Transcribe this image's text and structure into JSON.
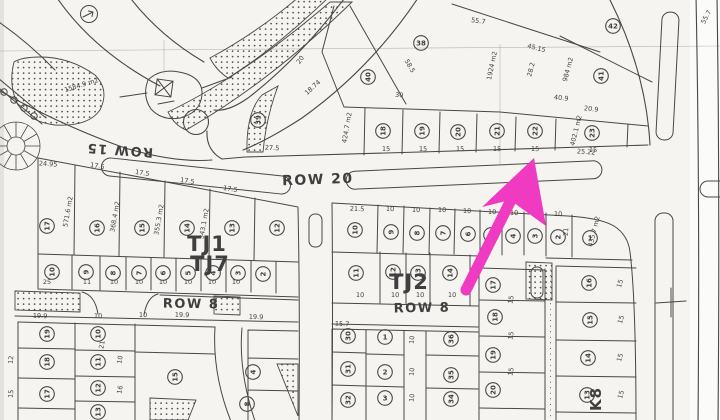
{
  "map": {
    "type": "cadastral-plat-map",
    "road_labels": [
      {
        "t": "ROW 15",
        "x": 120,
        "y": 146,
        "rot": 184,
        "size": 13
      },
      {
        "t": "ROW 20",
        "x": 318,
        "y": 184,
        "rot": -2,
        "size": 14
      },
      {
        "t": "ROW 8",
        "x": 191,
        "y": 308,
        "rot": 1,
        "size": 13
      },
      {
        "t": "ROW 8",
        "x": 422,
        "y": 312,
        "rot": -1,
        "size": 13
      }
    ],
    "block_labels": [
      {
        "t": "TJ1",
        "x": 207,
        "y": 251,
        "rot": 0,
        "size": 21
      },
      {
        "t": "TJ7",
        "x": 210,
        "y": 271,
        "rot": 0,
        "size": 21
      },
      {
        "t": "TJ2",
        "x": 409,
        "y": 289,
        "rot": 0,
        "size": 21
      },
      {
        "t": "K8",
        "x": 601,
        "y": 399,
        "rot": -90,
        "size": 15
      }
    ],
    "area_labels": [
      {
        "t": "1584.9 m2",
        "x": 82,
        "y": 87,
        "rot": -17
      },
      {
        "t": "1924 m2",
        "x": 494,
        "y": 66,
        "rot": -78
      },
      {
        "t": "984 m2",
        "x": 570,
        "y": 70,
        "rot": -75
      },
      {
        "t": "424.7 m2",
        "x": 349,
        "y": 128,
        "rot": -80
      },
      {
        "t": "402.1 m2",
        "x": 578,
        "y": 131,
        "rot": -76
      },
      {
        "t": "435.7 m2",
        "x": 596,
        "y": 232,
        "rot": -76
      },
      {
        "t": "571.6 m2",
        "x": 70,
        "y": 212,
        "rot": -80
      },
      {
        "t": "368.4 m2",
        "x": 117,
        "y": 217,
        "rot": -80
      },
      {
        "t": "355.3 m2",
        "x": 161,
        "y": 220,
        "rot": -80
      },
      {
        "t": "343.1 m2",
        "x": 206,
        "y": 224,
        "rot": -80
      }
    ],
    "dim_labels": [
      {
        "t": "55.7",
        "x": 478,
        "y": 23,
        "rot": 8
      },
      {
        "t": "58.5",
        "x": 408,
        "y": 67,
        "rot": 60
      },
      {
        "t": "30",
        "x": 399,
        "y": 97,
        "rot": 5
      },
      {
        "t": "20",
        "x": 302,
        "y": 61,
        "rot": -55
      },
      {
        "t": "18.74",
        "x": 314,
        "y": 89,
        "rot": -42
      },
      {
        "t": "28.2",
        "x": 533,
        "y": 70,
        "rot": -75
      },
      {
        "t": "45.15",
        "x": 536,
        "y": 50,
        "rot": 14
      },
      {
        "t": "27.5",
        "x": 272,
        "y": 150,
        "rot": 3
      },
      {
        "t": "40.9",
        "x": 561,
        "y": 100,
        "rot": 6
      },
      {
        "t": "20.9",
        "x": 591,
        "y": 111,
        "rot": 6
      },
      {
        "t": "25.22",
        "x": 586,
        "y": 154,
        "rot": 4
      },
      {
        "t": "55.7",
        "x": 708,
        "y": 18,
        "rot": -62
      },
      {
        "t": "15",
        "x": 386,
        "y": 151,
        "rot": 2
      },
      {
        "t": "15",
        "x": 423,
        "y": 151,
        "rot": 2
      },
      {
        "t": "15",
        "x": 460,
        "y": 151,
        "rot": 2
      },
      {
        "t": "15",
        "x": 497,
        "y": 151,
        "rot": 2
      },
      {
        "t": "15",
        "x": 535,
        "y": 151,
        "rot": 2
      },
      {
        "t": "15",
        "x": 593,
        "y": 152,
        "rot": 2
      },
      {
        "t": "24.95",
        "x": 48,
        "y": 166,
        "rot": 4
      },
      {
        "t": "17.5",
        "x": 97,
        "y": 168,
        "rot": 9
      },
      {
        "t": "17.5",
        "x": 142,
        "y": 175,
        "rot": 9
      },
      {
        "t": "17.5",
        "x": 187,
        "y": 183,
        "rot": 9
      },
      {
        "t": "17.5",
        "x": 230,
        "y": 191,
        "rot": 9
      },
      {
        "t": "25",
        "x": 47,
        "y": 284,
        "rot": 0
      },
      {
        "t": "11",
        "x": 87,
        "y": 284,
        "rot": 0
      },
      {
        "t": "10",
        "x": 114,
        "y": 284,
        "rot": 0
      },
      {
        "t": "10",
        "x": 139,
        "y": 284,
        "rot": 0
      },
      {
        "t": "10",
        "x": 163,
        "y": 284,
        "rot": 0
      },
      {
        "t": "10",
        "x": 188,
        "y": 284,
        "rot": 0
      },
      {
        "t": "10",
        "x": 212,
        "y": 284,
        "rot": 0
      },
      {
        "t": "10",
        "x": 236,
        "y": 284,
        "rot": 0
      },
      {
        "t": "21.5",
        "x": 357,
        "y": 211,
        "rot": 2
      },
      {
        "t": "10",
        "x": 390,
        "y": 211,
        "rot": 2
      },
      {
        "t": "10",
        "x": 416,
        "y": 212,
        "rot": 2
      },
      {
        "t": "10",
        "x": 442,
        "y": 212,
        "rot": 2
      },
      {
        "t": "10",
        "x": 467,
        "y": 213,
        "rot": 2
      },
      {
        "t": "10",
        "x": 492,
        "y": 214,
        "rot": 2
      },
      {
        "t": "10",
        "x": 514,
        "y": 215,
        "rot": 2
      },
      {
        "t": "10",
        "x": 536,
        "y": 216,
        "rot": 2
      },
      {
        "t": "10",
        "x": 558,
        "y": 216,
        "rot": 2
      },
      {
        "t": "21",
        "x": 568,
        "y": 232,
        "rot": -85
      },
      {
        "t": "10",
        "x": 360,
        "y": 297,
        "rot": 2
      },
      {
        "t": "10",
        "x": 395,
        "y": 297,
        "rot": 2
      },
      {
        "t": "10",
        "x": 420,
        "y": 297,
        "rot": 2
      },
      {
        "t": "10",
        "x": 452,
        "y": 297,
        "rot": 2
      },
      {
        "t": "19.9",
        "x": 40,
        "y": 318,
        "rot": 2
      },
      {
        "t": "10",
        "x": 98,
        "y": 318,
        "rot": 2
      },
      {
        "t": "10",
        "x": 143,
        "y": 317,
        "rot": 2
      },
      {
        "t": "19.9",
        "x": 182,
        "y": 317,
        "rot": 2
      },
      {
        "t": "19.9",
        "x": 256,
        "y": 319,
        "rot": 2
      },
      {
        "t": "12",
        "x": 13,
        "y": 360,
        "rot": -85
      },
      {
        "t": "15",
        "x": 13,
        "y": 394,
        "rot": -85
      },
      {
        "t": "21",
        "x": 104,
        "y": 345,
        "rot": -80
      },
      {
        "t": "10",
        "x": 122,
        "y": 360,
        "rot": -80
      },
      {
        "t": "16",
        "x": 122,
        "y": 390,
        "rot": -80
      },
      {
        "t": "15.7",
        "x": 342,
        "y": 326,
        "rot": 3
      },
      {
        "t": "10",
        "x": 414,
        "y": 340,
        "rot": -85
      },
      {
        "t": "10",
        "x": 414,
        "y": 372,
        "rot": -85
      },
      {
        "t": "10",
        "x": 414,
        "y": 398,
        "rot": -85
      },
      {
        "t": "15",
        "x": 513,
        "y": 300,
        "rot": -80
      },
      {
        "t": "15",
        "x": 513,
        "y": 336,
        "rot": -80
      },
      {
        "t": "15",
        "x": 513,
        "y": 372,
        "rot": -80
      },
      {
        "t": "15",
        "x": 622,
        "y": 284,
        "rot": -75
      },
      {
        "t": "15",
        "x": 623,
        "y": 320,
        "rot": -75
      },
      {
        "t": "15",
        "x": 622,
        "y": 358,
        "rot": -75
      },
      {
        "t": "15",
        "x": 623,
        "y": 395,
        "rot": -75
      }
    ],
    "lot_markers": [
      {
        "n": "39",
        "x": 258,
        "y": 120,
        "rot": -90
      },
      {
        "n": "40",
        "x": 368,
        "y": 77,
        "rot": -90
      },
      {
        "n": "38",
        "x": 421,
        "y": 43,
        "rot": 0
      },
      {
        "n": "42",
        "x": 613,
        "y": 26,
        "rot": 0
      },
      {
        "n": "41",
        "x": 601,
        "y": 76,
        "rot": -90
      },
      {
        "n": "18",
        "x": 383,
        "y": 131,
        "rot": -90
      },
      {
        "n": "19",
        "x": 422,
        "y": 131,
        "rot": -90
      },
      {
        "n": "20",
        "x": 458,
        "y": 132,
        "rot": -90
      },
      {
        "n": "21",
        "x": 497,
        "y": 131,
        "rot": -90
      },
      {
        "n": "22",
        "x": 535,
        "y": 131,
        "rot": -90
      },
      {
        "n": "23",
        "x": 592,
        "y": 133,
        "rot": -90
      },
      {
        "n": "17",
        "x": 47,
        "y": 226,
        "rot": -90
      },
      {
        "n": "16",
        "x": 97,
        "y": 228,
        "rot": -90
      },
      {
        "n": "15",
        "x": 142,
        "y": 228,
        "rot": -90
      },
      {
        "n": "14",
        "x": 187,
        "y": 228,
        "rot": -90
      },
      {
        "n": "13",
        "x": 232,
        "y": 228,
        "rot": -90
      },
      {
        "n": "12",
        "x": 277,
        "y": 228,
        "rot": -90
      },
      {
        "n": "10",
        "x": 52,
        "y": 272,
        "rot": -90
      },
      {
        "n": "9",
        "x": 86,
        "y": 272,
        "rot": -90
      },
      {
        "n": "8",
        "x": 113,
        "y": 273,
        "rot": -90
      },
      {
        "n": "7",
        "x": 139,
        "y": 273,
        "rot": -90
      },
      {
        "n": "6",
        "x": 163,
        "y": 273,
        "rot": -90
      },
      {
        "n": "5",
        "x": 188,
        "y": 273,
        "rot": -90
      },
      {
        "n": "4",
        "x": 213,
        "y": 273,
        "rot": -90
      },
      {
        "n": "3",
        "x": 238,
        "y": 273,
        "rot": -90
      },
      {
        "n": "2",
        "x": 263,
        "y": 274,
        "rot": -90
      },
      {
        "n": "10",
        "x": 355,
        "y": 230,
        "rot": -90
      },
      {
        "n": "9",
        "x": 391,
        "y": 232,
        "rot": -90
      },
      {
        "n": "8",
        "x": 417,
        "y": 233,
        "rot": -90
      },
      {
        "n": "7",
        "x": 443,
        "y": 233,
        "rot": -90
      },
      {
        "n": "6",
        "x": 468,
        "y": 234,
        "rot": -90
      },
      {
        "n": "5",
        "x": 491,
        "y": 235,
        "rot": -90
      },
      {
        "n": "4",
        "x": 513,
        "y": 236,
        "rot": -90
      },
      {
        "n": "3",
        "x": 535,
        "y": 236,
        "rot": -90
      },
      {
        "n": "2",
        "x": 558,
        "y": 237,
        "rot": -90
      },
      {
        "n": "1",
        "x": 590,
        "y": 238,
        "rot": 0
      },
      {
        "n": "11",
        "x": 356,
        "y": 273,
        "rot": -90
      },
      {
        "n": "12",
        "x": 393,
        "y": 272,
        "rot": -90
      },
      {
        "n": "13",
        "x": 418,
        "y": 273,
        "rot": -90
      },
      {
        "n": "14",
        "x": 450,
        "y": 273,
        "rot": -90
      },
      {
        "n": "19",
        "x": 47,
        "y": 334,
        "rot": -90
      },
      {
        "n": "18",
        "x": 47,
        "y": 362,
        "rot": -90
      },
      {
        "n": "17",
        "x": 47,
        "y": 394,
        "rot": -90
      },
      {
        "n": "10",
        "x": 98,
        "y": 334,
        "rot": -90
      },
      {
        "n": "11",
        "x": 98,
        "y": 362,
        "rot": -90
      },
      {
        "n": "12",
        "x": 98,
        "y": 388,
        "rot": -90
      },
      {
        "n": "13",
        "x": 98,
        "y": 412,
        "rot": -90
      },
      {
        "n": "15",
        "x": 175,
        "y": 377,
        "rot": -90
      },
      {
        "n": "4",
        "x": 253,
        "y": 372,
        "rot": -90
      },
      {
        "n": "8",
        "x": 247,
        "y": 404,
        "rot": -90
      },
      {
        "n": "30",
        "x": 348,
        "y": 336,
        "rot": -90
      },
      {
        "n": "31",
        "x": 348,
        "y": 369,
        "rot": -90
      },
      {
        "n": "32",
        "x": 348,
        "y": 400,
        "rot": -90
      },
      {
        "n": "1",
        "x": 385,
        "y": 337,
        "rot": 0
      },
      {
        "n": "2",
        "x": 385,
        "y": 372,
        "rot": 0
      },
      {
        "n": "3",
        "x": 385,
        "y": 398,
        "rot": 0
      },
      {
        "n": "36",
        "x": 451,
        "y": 339,
        "rot": -90
      },
      {
        "n": "35",
        "x": 451,
        "y": 375,
        "rot": -90
      },
      {
        "n": "34",
        "x": 451,
        "y": 399,
        "rot": -90
      },
      {
        "n": "17",
        "x": 493,
        "y": 285,
        "rot": -90
      },
      {
        "n": "18",
        "x": 495,
        "y": 317,
        "rot": -90
      },
      {
        "n": "19",
        "x": 493,
        "y": 355,
        "rot": -90
      },
      {
        "n": "20",
        "x": 493,
        "y": 390,
        "rot": -90
      },
      {
        "n": "16",
        "x": 589,
        "y": 283,
        "rot": -90
      },
      {
        "n": "15",
        "x": 590,
        "y": 320,
        "rot": -90
      },
      {
        "n": "14",
        "x": 588,
        "y": 358,
        "rot": -90
      },
      {
        "n": "13",
        "x": 587,
        "y": 395,
        "rot": -90
      }
    ],
    "symbols": [
      {
        "name": "roundabout-circle"
      },
      {
        "name": "utility-box-x-symbol"
      },
      {
        "name": "circle-arrow-symbol"
      },
      {
        "name": "rosette-radial-symbol"
      },
      {
        "name": "survey-cross-symbol"
      }
    ],
    "colors": {
      "paper": "#f5f4f0",
      "ink": "#474747",
      "dim_text": "#4c4c4c"
    }
  },
  "annotation": {
    "arrow_color": "#ef3ac1",
    "meaning": "highlight-arrow"
  }
}
